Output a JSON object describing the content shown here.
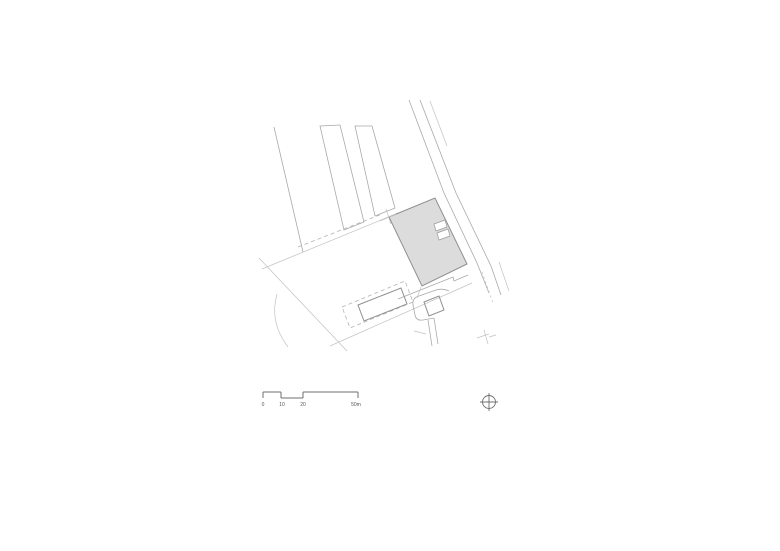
{
  "drawing": {
    "kind": "architectural-site-plan",
    "main_building": {
      "fill": "#dcdcdc",
      "outline": "#8f8f8f"
    }
  },
  "scale_bar": {
    "labels": [
      "0",
      "10",
      "20",
      "50m"
    ]
  },
  "north_indicator": {
    "icon": "north-crosshair-icon"
  },
  "colors": {
    "background": "#ffffff",
    "building_fill": "#dcdcdc",
    "building_outline": "#8f8f8f",
    "drawing_line_mid": "#a9a9a9",
    "drawing_line_light": "#c2c2c2",
    "label_text": "#555555"
  }
}
